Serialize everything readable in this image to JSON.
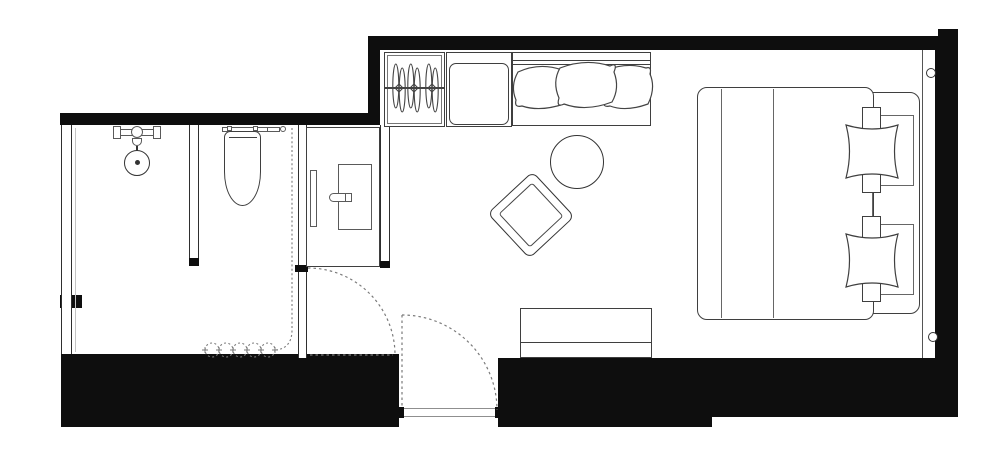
{
  "document": {
    "kind": "architectural-floor-plan",
    "orientation": "landscape",
    "text_labels": []
  },
  "palette": {
    "wall": "#0e0e0e",
    "furniture_line": "#3f3f3f",
    "light_line": "#8c8c8c",
    "dashed_line": "#7a7a7a",
    "background": "#ffffff"
  },
  "rooms": [
    {
      "name": "shower-room",
      "fixtures": [
        "shower-head",
        "shower-valve"
      ]
    },
    {
      "name": "toilet-room",
      "fixtures": [
        "toilet",
        "privacy-curtain"
      ]
    },
    {
      "name": "vanity-area",
      "fixtures": [
        "vanity-counter",
        "sink",
        "faucet",
        "wall-sconce"
      ]
    },
    {
      "name": "entry-hall",
      "fixtures": [
        "entry-door",
        "bathroom-door",
        "threshold"
      ]
    },
    {
      "name": "bedroom",
      "fixtures": [
        "wardrobe",
        "hangers",
        "minibar-cabinet",
        "sofa",
        "sofa-pillows",
        "round-side-table",
        "diamond-side-table",
        "double-bed",
        "duvet",
        "pillows",
        "bench",
        "wall-light",
        "wall-light"
      ]
    }
  ],
  "counts": {
    "hangers": 3,
    "sofa_pillows": 3,
    "bed_pillow_groups": 2,
    "door_swings": 2
  },
  "doors": [
    {
      "name": "bathroom-door",
      "style": "dashed-swing-arc"
    },
    {
      "name": "entry-door",
      "style": "dashed-swing-arc"
    }
  ]
}
